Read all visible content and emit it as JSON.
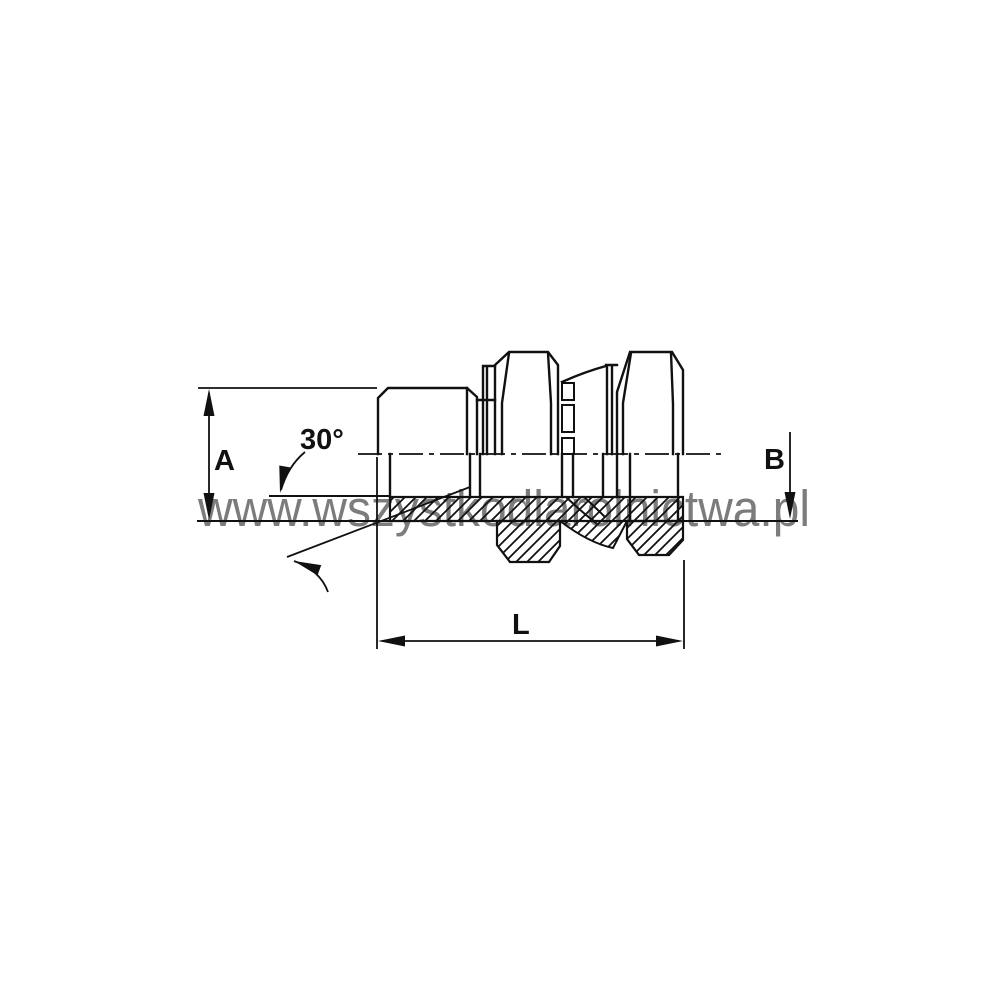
{
  "dimensions": {
    "a": "A",
    "b": "B",
    "length": "L",
    "cone_angle": "30°"
  },
  "watermark": {
    "text": "www.wszystkodlarolnictwa.pl",
    "color": "#7c7c7c"
  },
  "colors": {
    "line": "#111111",
    "background": "#ffffff"
  }
}
